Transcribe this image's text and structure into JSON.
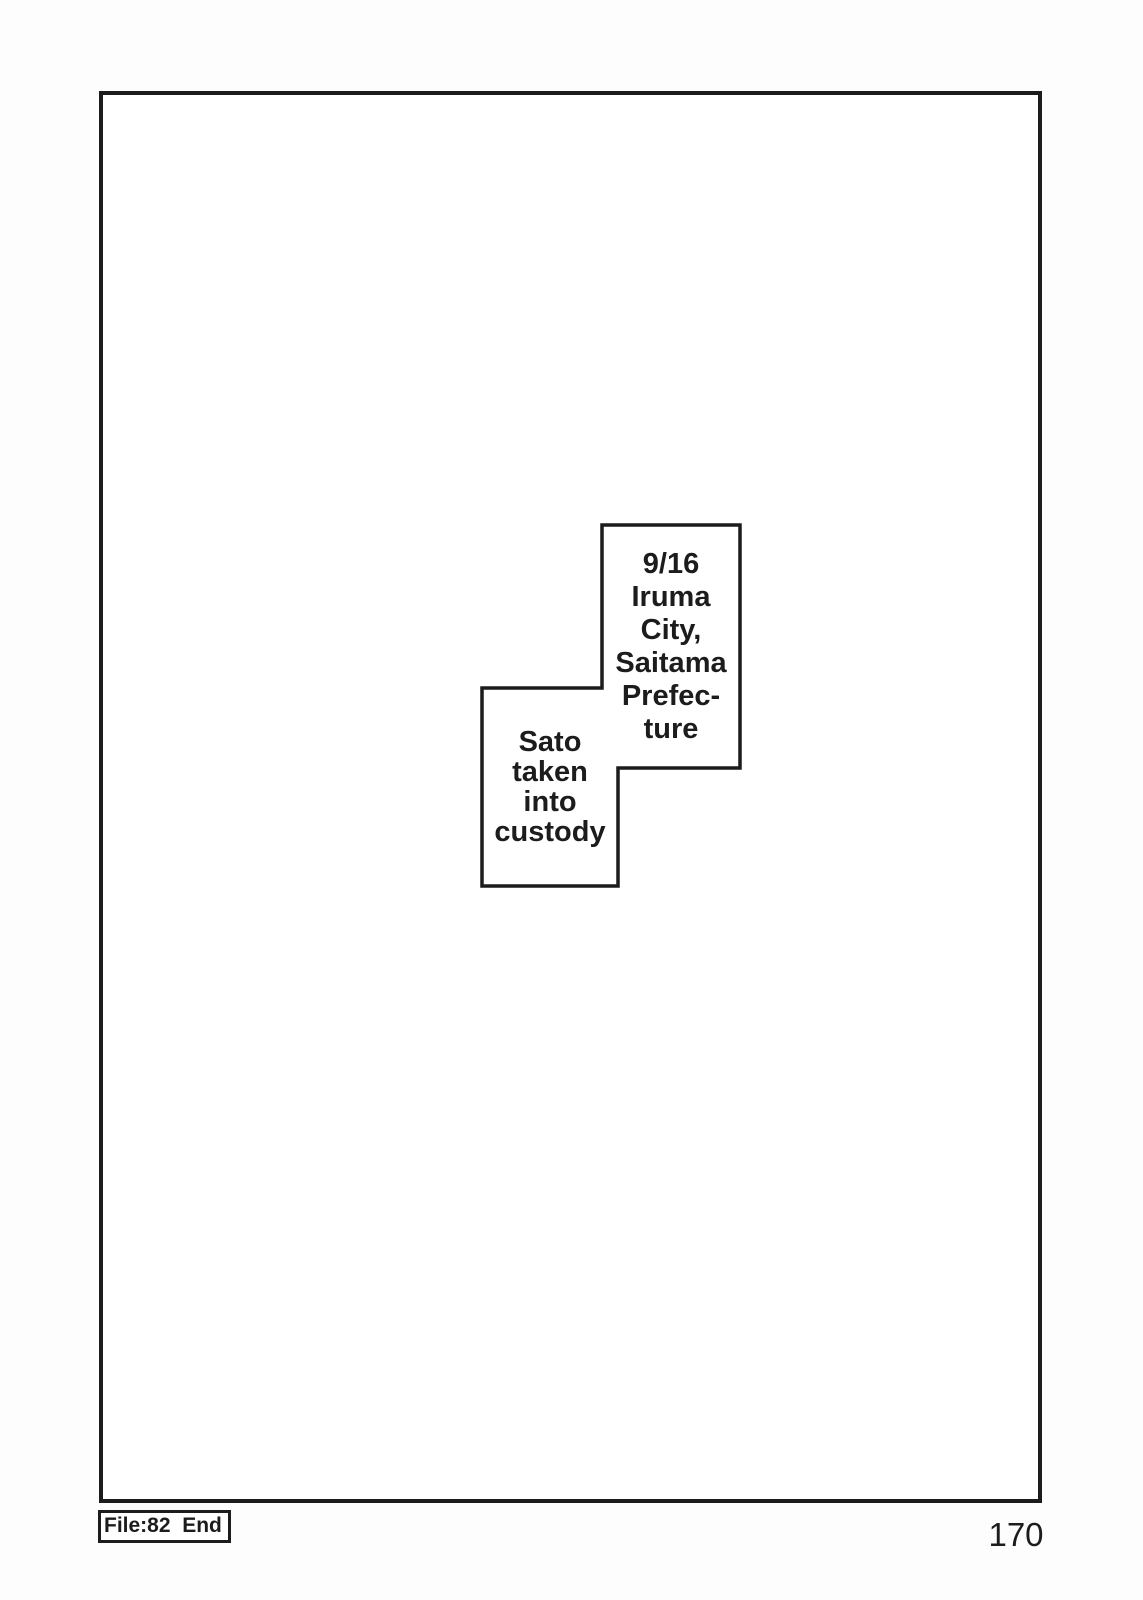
{
  "colors": {
    "ink": "#1c1c1c",
    "paper": "#ffffff",
    "background": "#fdfdfd"
  },
  "captions": {
    "date_location": "9/16\nIruma\nCity,\nSaitama\nPrefec-\nture",
    "event": "Sato\ntaken\ninto\ncustody"
  },
  "footer": {
    "file_label": "File:82  End",
    "page_number": "170"
  }
}
